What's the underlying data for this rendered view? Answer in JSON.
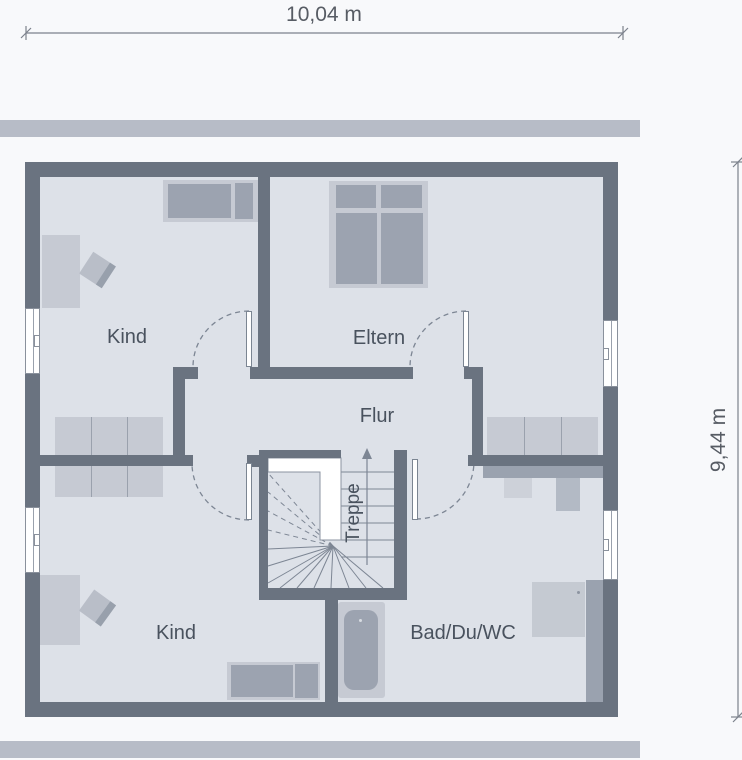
{
  "dimensions": {
    "width": "10,04 m",
    "height": "9,44 m"
  },
  "rooms": {
    "kind_top": "Kind",
    "eltern": "Eltern",
    "flur": "Flur",
    "treppe": "Treppe",
    "kind_bottom": "Kind",
    "bad": "Bad/Du/WC"
  },
  "colors": {
    "wall": "#6a7380",
    "room_fill": "#dde1e8",
    "page_bg": "#f8f9fb",
    "roof_band": "#b7bcc7",
    "furniture_light": "#c6cad3",
    "furniture_medium": "#9ca3b0",
    "knee_wall": "#9aa2af",
    "line": "#7d8694",
    "text": "#49525e",
    "dim_text": "#575c64"
  }
}
